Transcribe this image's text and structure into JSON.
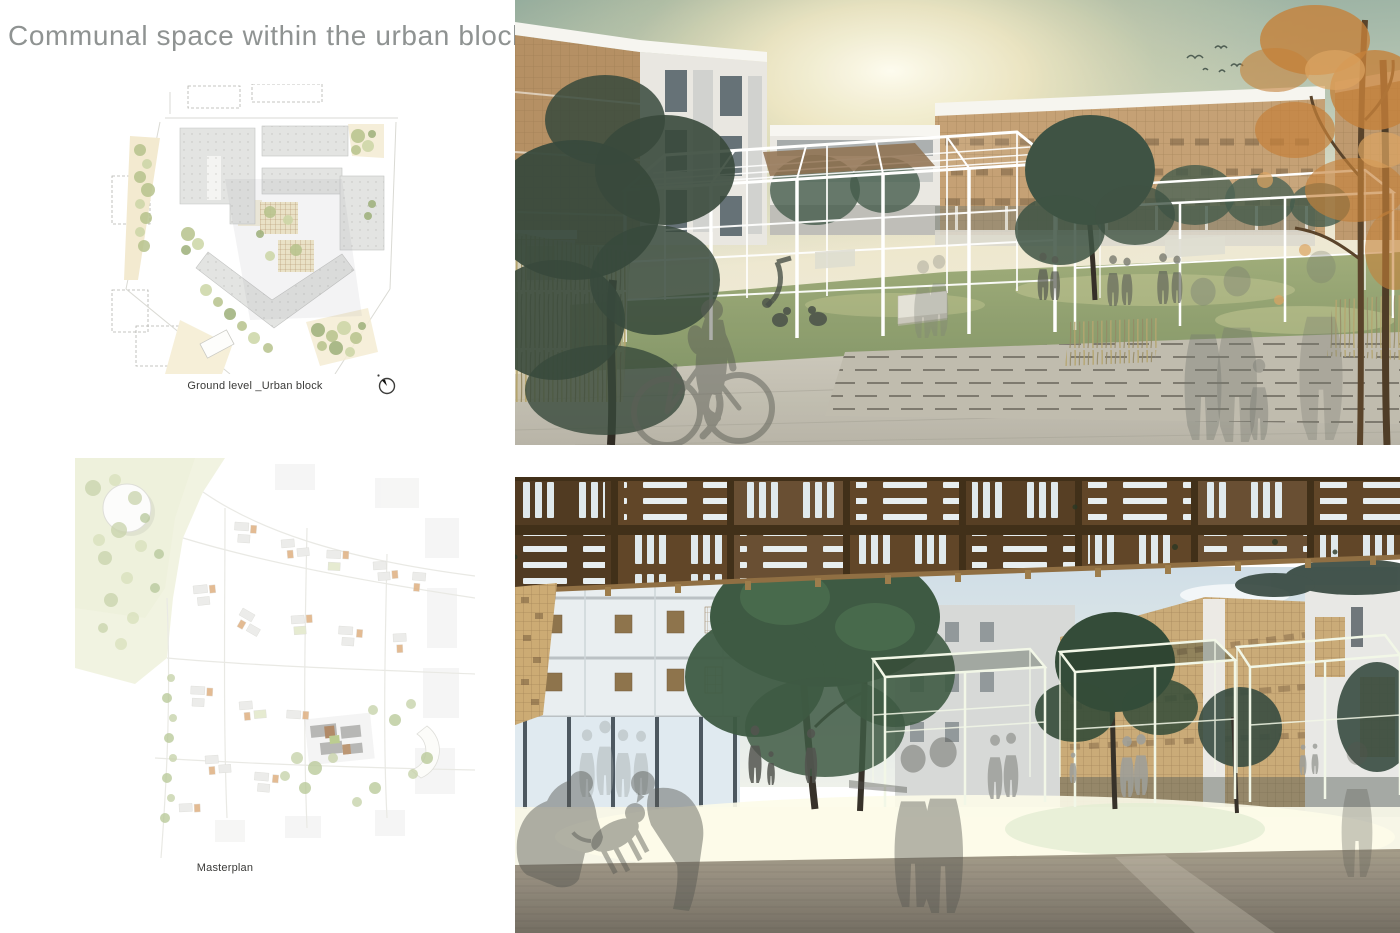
{
  "page": {
    "title": "Communal space within the urban block"
  },
  "plans": [
    {
      "caption": "Ground level _Urban block",
      "icon": "north-arrow-icon"
    },
    {
      "caption": "Masterplan"
    }
  ],
  "renders": [
    {
      "id": "communal-lawn-render"
    },
    {
      "id": "timber-canopy-courtyard-render"
    }
  ],
  "colors": {
    "board-bg": "#ffffff",
    "title-gray": "#8f9392",
    "caption-dark": "#3a3a38",
    "sky-teal": "#87a396",
    "sun-warm": "#fdf3d4",
    "lattice-wood": "#c29c6e",
    "parapet-white": "#f6f5f0",
    "tree-dark": "#2e4136",
    "autumn-orange": "#c2792f",
    "lawn-green": "#93a36b",
    "pavement-gray": "#c6c2b5",
    "canopy-wood": "#5b3f20",
    "canopy-slot": "#dfe9ec",
    "ground-olive": "#8a8274",
    "silhouette-gray": "#53554e",
    "plan-building": "#e3e4e2",
    "plan-cream": "#f3ead0",
    "plan-tree-green": "#b7c38c",
    "masterplan-accent": "#d79a5e"
  }
}
